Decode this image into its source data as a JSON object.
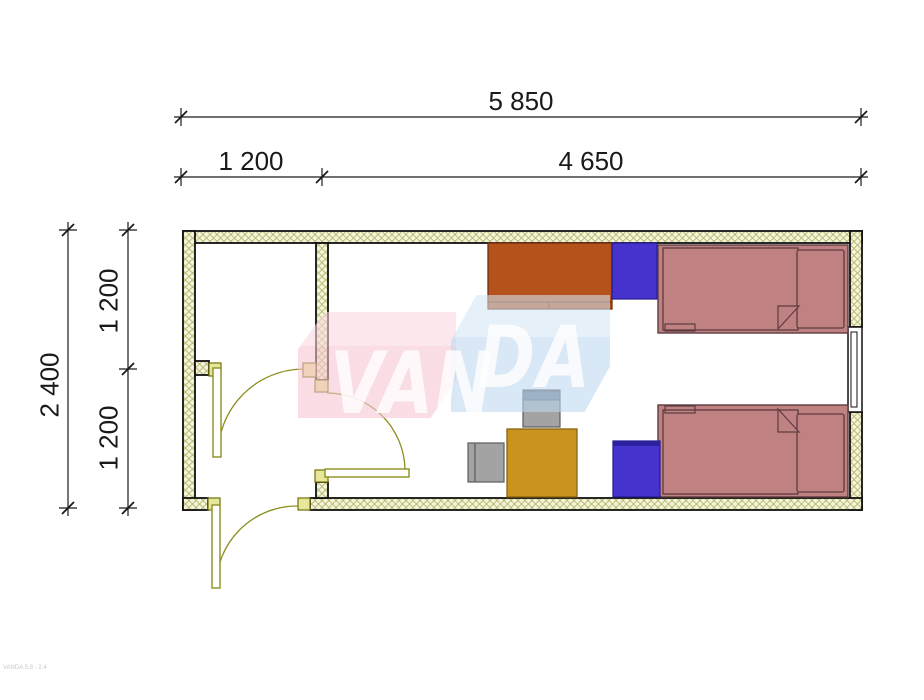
{
  "dimensions": {
    "top_primary": "5 850",
    "top_left_segment": "1 200",
    "top_right_segment": "4 650",
    "left_overall": "2 400",
    "left_upper_segment": "1 200",
    "left_lower_segment": "1 200"
  },
  "watermark": {
    "left_text": "VAN",
    "right_text": "DA"
  },
  "footer": {
    "text": "VANDA 5.8 - 2.4"
  },
  "plan": {
    "rooms": [
      "vestibule",
      "main-room"
    ],
    "furniture": [
      "wardrobe",
      "nightstand-top",
      "bed-top",
      "bed-bottom",
      "nightstand-bottom",
      "desk",
      "chair-at-desk",
      "chair-side"
    ],
    "openings": [
      "entrance-door",
      "vestibule-door",
      "room-door",
      "window"
    ]
  },
  "colors": {
    "wall_fill": "#f4f4da",
    "wall_hatch": "#b0b163",
    "wall_outline": "#111111",
    "frame_yellow": "#e7e79a",
    "frame_outline": "#70700a",
    "door_olive": "#8e8e20",
    "bed_fill": "#c08183",
    "bed_outline": "#5d3c3f",
    "wardrobe": "#b5521b",
    "wardrobe_outline": "#6e2f0e",
    "nightstand": "#4633cd",
    "nightstand_outline": "#221a8e",
    "nightstand_band": "#2c209f",
    "desk": "#c9931d",
    "desk_outline": "#8a6210",
    "chair": "#a3a3a3",
    "chair_dark": "#6f7d8d",
    "chair_outline": "#5c5c5c",
    "dim_line": "#1a1a1a",
    "watermark_pink": "#f6c5d1",
    "watermark_pink_light": "#fad7de",
    "watermark_blue": "#bed8ef",
    "watermark_blue_light": "#d3e5f4",
    "watermark_text": "#ffffff"
  }
}
